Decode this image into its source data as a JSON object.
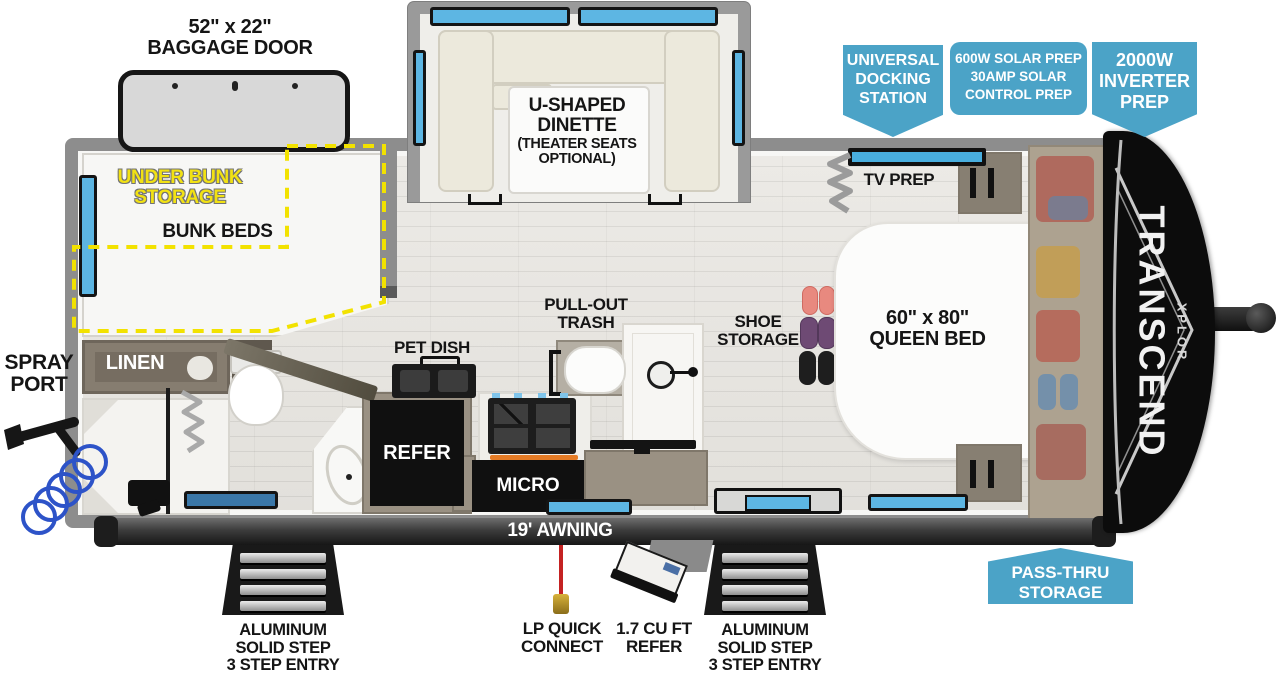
{
  "branding": {
    "model": "TRANSCEND",
    "submodel": "XPLOR"
  },
  "callouts": {
    "docking": [
      "UNIVERSAL",
      "DOCKING",
      "STATION"
    ],
    "solar": [
      "600W SOLAR PREP",
      "30AMP SOLAR",
      "CONTROL PREP"
    ],
    "inverter": [
      "2000W",
      "INVERTER",
      "PREP"
    ],
    "passthru": [
      "PASS-THRU",
      "STORAGE"
    ]
  },
  "exterior": {
    "baggage_door": [
      "52\" x 22\"",
      "BAGGAGE DOOR"
    ],
    "spray_port": [
      "SPRAY",
      "PORT"
    ],
    "awning": "19' AWNING",
    "lp_quick_connect": [
      "LP QUICK",
      "CONNECT"
    ],
    "exterior_refer": [
      "1.7 CU FT",
      "REFER"
    ],
    "entry_steps": [
      "ALUMINUM",
      "SOLID STEP",
      "3 STEP ENTRY"
    ]
  },
  "interior": {
    "under_bunk_storage": [
      "UNDER BUNK",
      "STORAGE"
    ],
    "bunk_beds": "BUNK BEDS",
    "linen": "LINEN",
    "pet_dish": "PET DISH",
    "pull_out_trash": [
      "PULL-OUT",
      "TRASH"
    ],
    "refer": "REFER",
    "micro": "MICRO",
    "shoe_storage": [
      "SHOE",
      "STORAGE"
    ],
    "tv_prep": "TV PREP",
    "queen_bed": [
      "60\" x 80\"",
      "QUEEN BED"
    ],
    "dinette": [
      "U-SHAPED",
      "DINETTE",
      "(THEATER SEATS",
      "OPTIONAL)"
    ]
  },
  "colors": {
    "callout_blue": "#4BA3C7",
    "window_blue": "#5DB6E3",
    "storage_outline_yellow": "#F2E200",
    "wall_gray": "#8D8D8D"
  }
}
